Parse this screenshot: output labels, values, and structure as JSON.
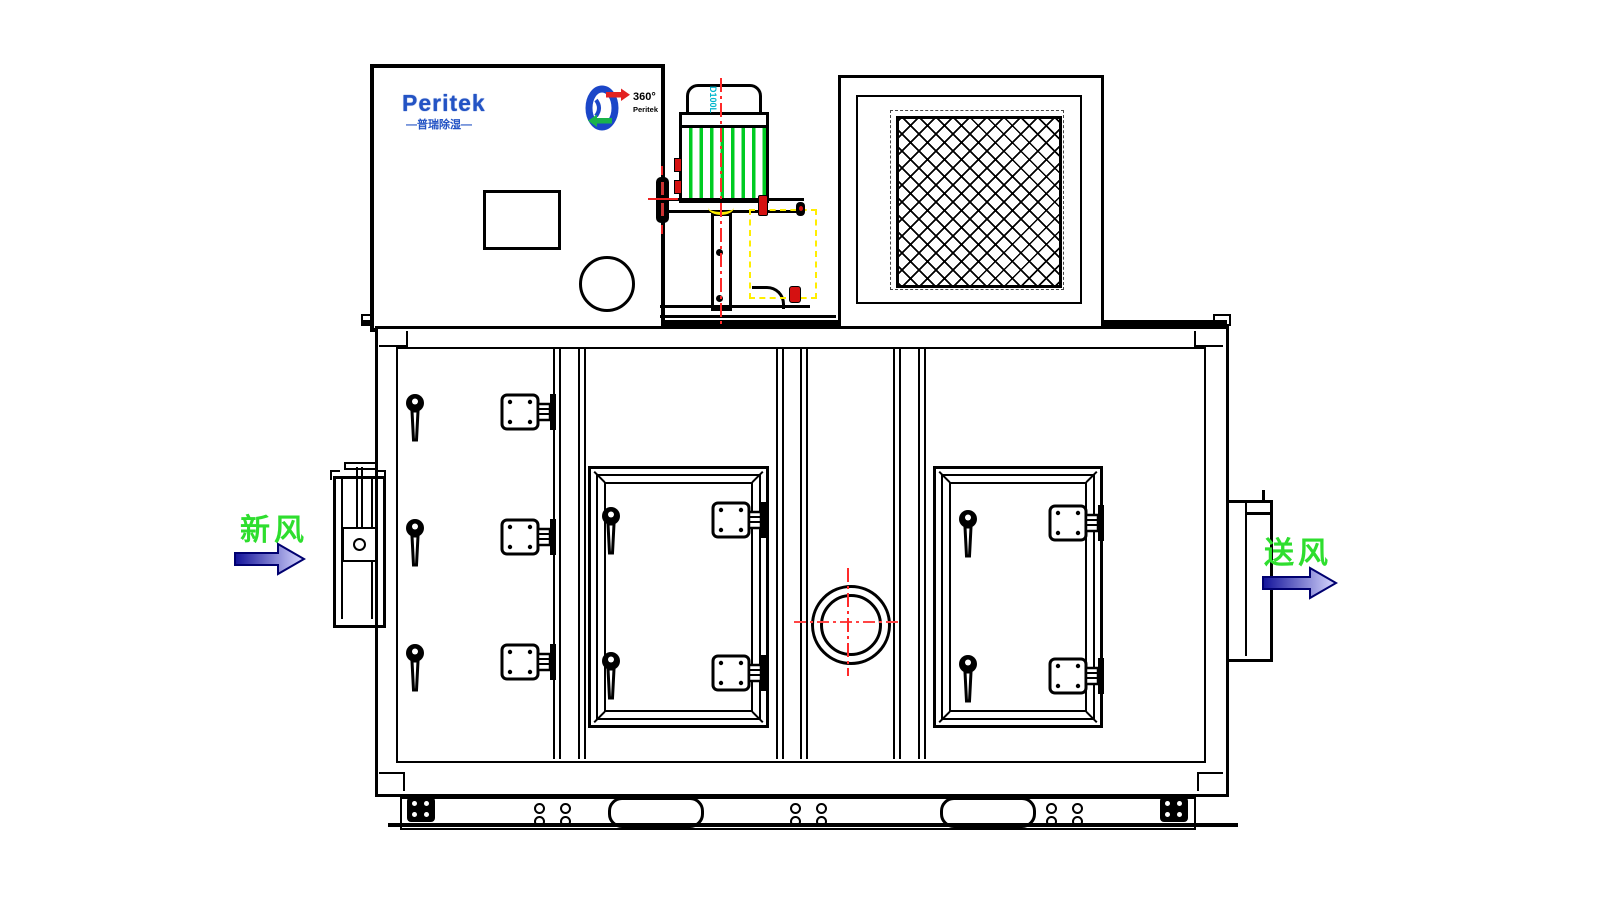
{
  "brand": {
    "name": "Peritek",
    "subtitle": "—普瑞除湿—",
    "badge_degrees": "360°",
    "badge_name": "Peritek"
  },
  "motor": {
    "model": "D100L"
  },
  "flow_labels": {
    "fresh_air": "新风",
    "supply_air": "送风"
  },
  "colors": {
    "line_black": "#000000",
    "brand_blue": "#2353c4",
    "label_green": "#2ede2e",
    "centerline_red": "#ff2a2a",
    "motor_fin_green": "#00cc22",
    "dash_yellow": "#ffee00",
    "model_cyan": "#00b6cc",
    "arrow_dark_blue": "#12129a",
    "arrow_light_blue": "#d9d9ff",
    "rotor_logo_blue": "#1b46c8",
    "rotor_arrow_red": "#e32222",
    "rotor_arrow_green": "#19b24b"
  }
}
